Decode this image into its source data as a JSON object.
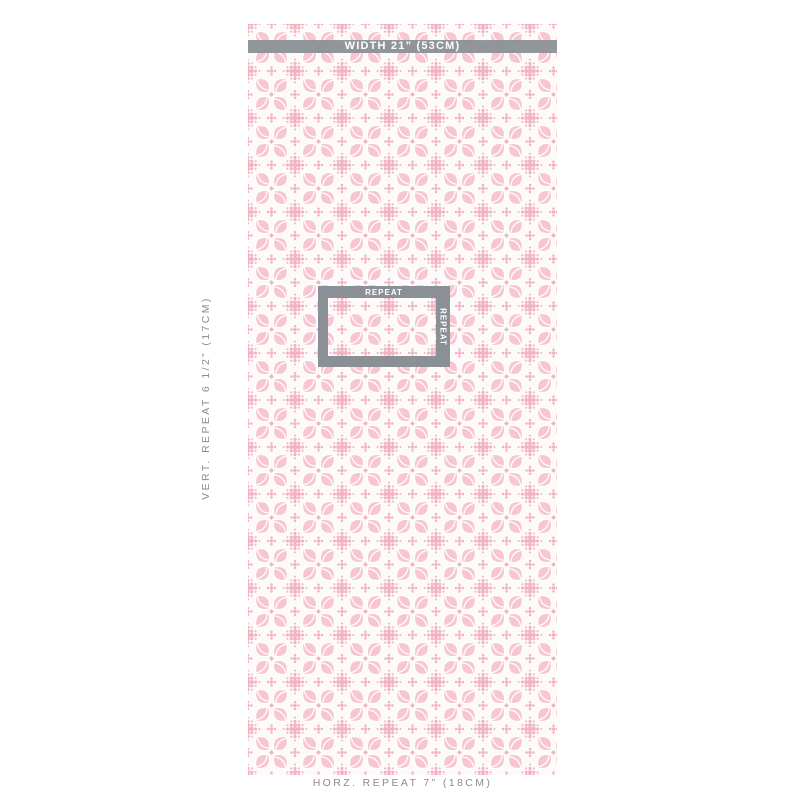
{
  "swatch": {
    "description": "pale pink four-petal medallion wallpaper with dotted diamond interstices",
    "colors": {
      "petal_pink": "#f7c6d1",
      "dot_pink": "#f2b2c2",
      "fabric_background": "#fdfafa",
      "vein_white": "#ffffff",
      "measure_bar_gray": "#8b9096",
      "label_gray": "#8c8c8c",
      "label_white": "#ffffff",
      "page_background": "#ffffff"
    }
  },
  "annotations": {
    "width_bar": {
      "label": "WIDTH 21” (53CM)"
    },
    "repeat_box": {
      "top_label": "REPEAT",
      "side_label": "REPEAT"
    },
    "vert_repeat_label": "VERT. REPEAT 6 1/2” (17CM)",
    "horz_repeat_label": "HORZ. REPEAT 7” (18CM)"
  }
}
